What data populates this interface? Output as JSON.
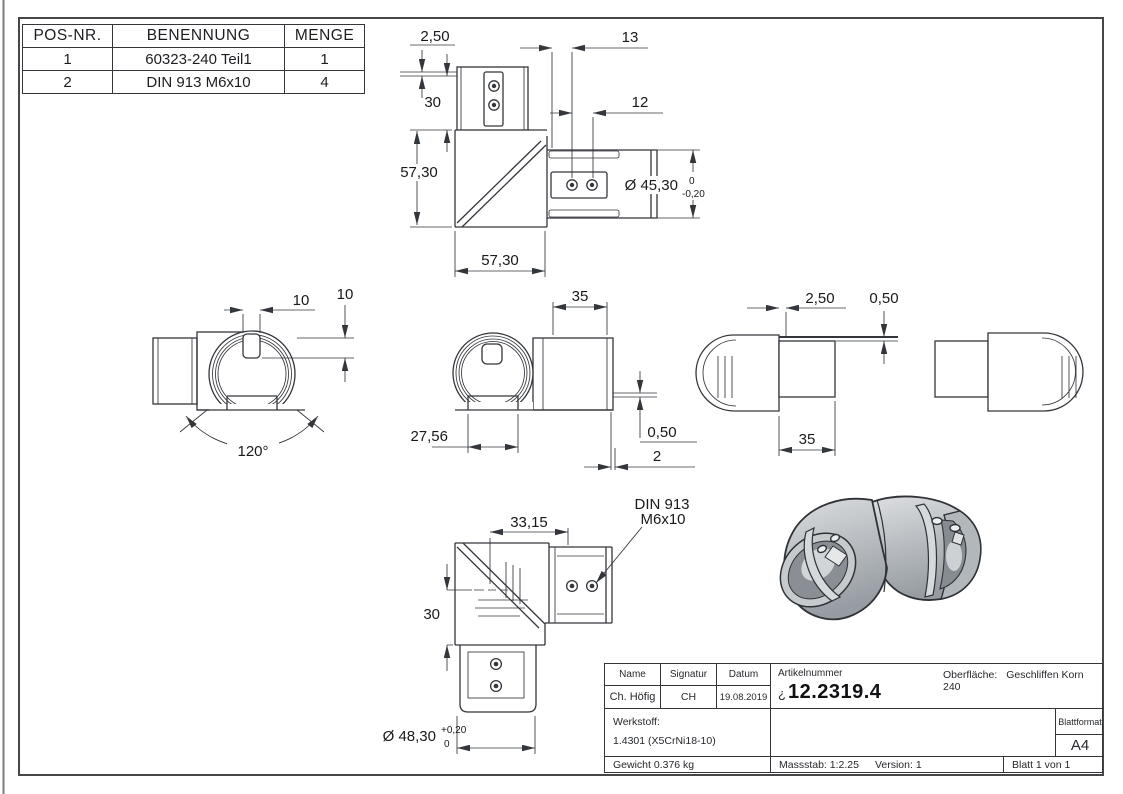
{
  "parts_table": {
    "headers": [
      "POS-NR.",
      "BENENNUNG",
      "MENGE"
    ],
    "rows": [
      [
        "1",
        "60323-240 Teil1",
        "1"
      ],
      [
        "2",
        "DIN 913 M6x10",
        "4"
      ]
    ]
  },
  "dims": {
    "top_view": {
      "lip": "2,50",
      "offset13": "13",
      "collar_h": "30",
      "hole_sp": "12",
      "body_h": "57,30",
      "body_w": "57,30",
      "dia": "Ø 45,30",
      "dia_tol_up": "0",
      "dia_tol_lo": "-0,20"
    },
    "left_view": {
      "slot_w": "10",
      "slot_d": "10",
      "angle": "120°"
    },
    "center_view": {
      "len": "35",
      "chord": "27,56",
      "lip": "0,50",
      "edge": "2"
    },
    "right_view": {
      "lip": "2,50",
      "step": "0,50",
      "len": "35"
    },
    "bottom_view": {
      "len": "33,15",
      "height": "30",
      "dia": "Ø 48,30",
      "dia_tol_up": "+0,20",
      "dia_tol_lo": "0",
      "note1": "DIN 913",
      "note2": "M6x10"
    }
  },
  "title_block": {
    "name_label": "Name",
    "signature_label": "Signatur",
    "date_label": "Datum",
    "name": "Ch. Höfig",
    "signature": "CH",
    "date": "19.08.2019",
    "article_label": "Artikelnummer",
    "article_prefix": "¿",
    "article_number": "12.2319.4",
    "surface_label": "Oberfläche:",
    "surface": "Geschliffen Korn 240",
    "material_label": "Werkstoff:",
    "material": "1.4301 (X5CrNi18-10)",
    "weight": "Gewicht 0.376 kg",
    "scale": "Massstab: 1:2.25",
    "version": "Version: 1",
    "sheet": "Blatt 1 von 1",
    "sheet_format_label": "Blattformat",
    "sheet_format": "A4"
  },
  "colors": {
    "line": "#33363b",
    "part_mid": "#b9bdc1",
    "part_light": "#dcdee0",
    "part_dark": "#8e949a",
    "outline": "#2e3236"
  }
}
